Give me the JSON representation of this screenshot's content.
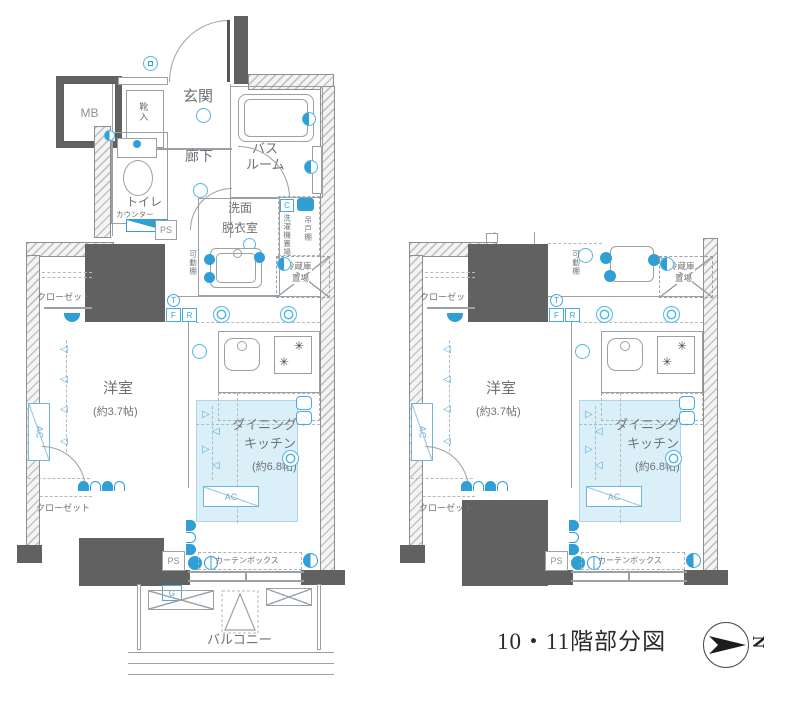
{
  "caption": "10・11階部分図",
  "compass": {
    "north": "N"
  },
  "colors": {
    "accent": "#2f9fd6",
    "wall": "#616161",
    "shade": "#bfe0f2",
    "line": "#9aa0a4"
  },
  "left": {
    "mb": "MB",
    "genkan": "玄関",
    "kutsuire": "靴入",
    "rouka": "廊下",
    "bath1": "バス",
    "bath2": "ルーム",
    "toilet": "トイレ",
    "counter": "カウンター",
    "ps_top": "PS",
    "senmen1": "洗面",
    "senmen2": "脱衣室",
    "c": "C",
    "washer": "洗濯機置場",
    "tsuridana": "吊戸棚",
    "fridge1": "冷蔵庫",
    "fridge2": "置場",
    "kadodana": "可動棚",
    "t": "T",
    "f": "F",
    "r": "R",
    "closet_top": "クローゼット",
    "closet_bottom": "クローゼット",
    "yoshitsu": "洋室",
    "yoshitsu_size": "(約3.7帖)",
    "ac_wall": "AC",
    "dk1": "ダイニング・",
    "dk2": "キッチン",
    "dk_size": "(約6.8帖)",
    "ac_dk": "AC",
    "curtain": "カーテンボックス",
    "ps_bottom": "PS",
    "g": "G",
    "balcony": "バルコニー"
  },
  "right": {
    "fridge1": "冷蔵庫",
    "fridge2": "置場",
    "kadodana": "可動棚",
    "t": "T",
    "f": "F",
    "r": "R",
    "closet_top": "クローゼット",
    "closet_bottom": "クローゼット",
    "yoshitsu": "洋室",
    "yoshitsu_size": "(約3.7帖)",
    "ac_wall": "AC",
    "dk1": "ダイニング・",
    "dk2": "キッチン",
    "dk_size": "(約6.8帖)",
    "ac_dk": "AC",
    "curtain": "カーテンボックス",
    "ps_bottom": "PS"
  }
}
